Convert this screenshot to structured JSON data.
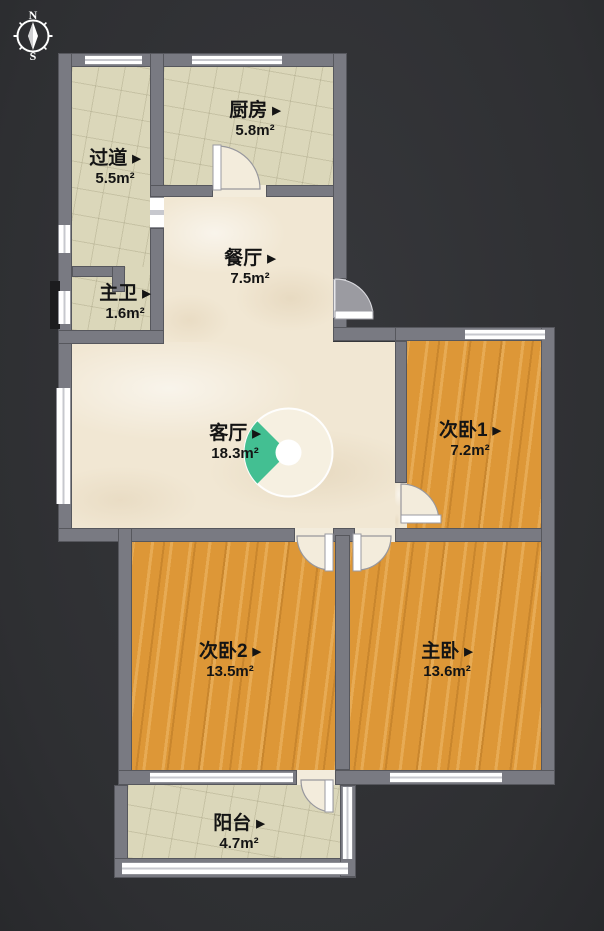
{
  "compass": {
    "north": "N",
    "south": "S"
  },
  "icons": {
    "room_arrow": "▶"
  },
  "rooms": [
    {
      "id": "kitchen",
      "name": "厨房",
      "area": "5.8m²"
    },
    {
      "id": "hallway",
      "name": "过道",
      "area": "5.5m²"
    },
    {
      "id": "master-bath",
      "name": "主卫",
      "area": "1.6m²"
    },
    {
      "id": "dining-room",
      "name": "餐厅",
      "area": "7.5m²"
    },
    {
      "id": "living-room",
      "name": "客厅",
      "area": "18.3m²"
    },
    {
      "id": "bedroom-1",
      "name": "次卧1",
      "area": "7.2m²"
    },
    {
      "id": "bedroom-2",
      "name": "次卧2",
      "area": "13.5m²"
    },
    {
      "id": "master-bedroom",
      "name": "主卧",
      "area": "13.6m²"
    },
    {
      "id": "balcony",
      "name": "阳台",
      "area": "4.7m²"
    }
  ],
  "colors": {
    "wall": "#797a82",
    "tile": "#dbd7ba",
    "marble": "#f1e7d3",
    "wood": "#dd9737",
    "accent_green": "#43bf92",
    "background": "#313236"
  }
}
